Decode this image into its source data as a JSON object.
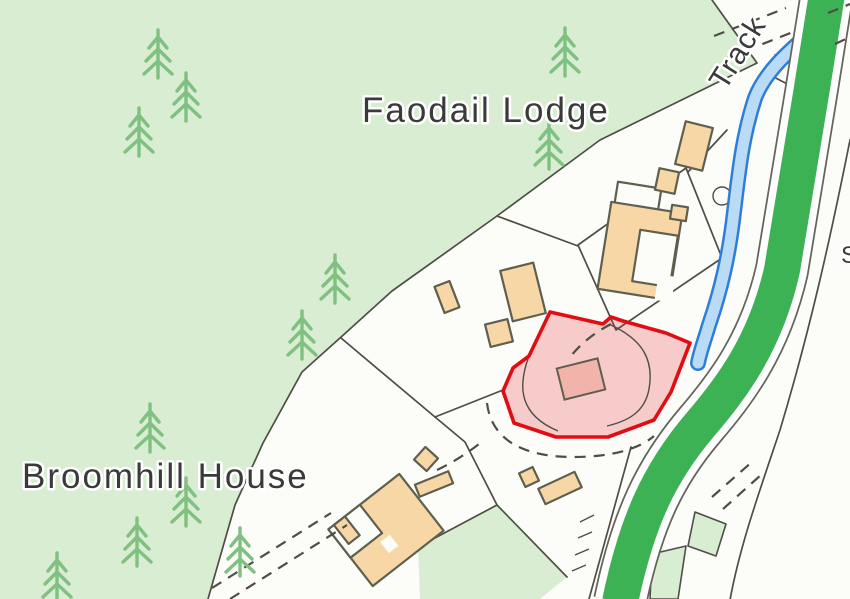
{
  "map": {
    "description": "Ordnance-Survey-style location plan with red highlighted property boundary",
    "labels": {
      "faodail_lodge": "Faodail Lodge",
      "broomhill_house": "Broomhill House",
      "track": "Track",
      "edge_partial": "S"
    },
    "highlight": {
      "meaning": "subject property boundary",
      "outline": "#e10d13",
      "fill": "#e63232",
      "fill_opacity": 0.24
    },
    "colors": {
      "paper": "#fcfcf9",
      "woodland": "#d9edd3",
      "tree": "#80c080",
      "boundary": "#4e4e46",
      "building_fill": "#f8d7a6",
      "building_stroke": "#5f5f50",
      "road_green": "#3db254",
      "road_casing": "#64645c",
      "stream_edge": "#2e7ed8",
      "stream_fill": "#b9dbf6",
      "plot_red": "#e10d13",
      "plot_fill": "#e63232",
      "plot_building": "#f2b4aa",
      "label": "#3a3a3a"
    }
  }
}
